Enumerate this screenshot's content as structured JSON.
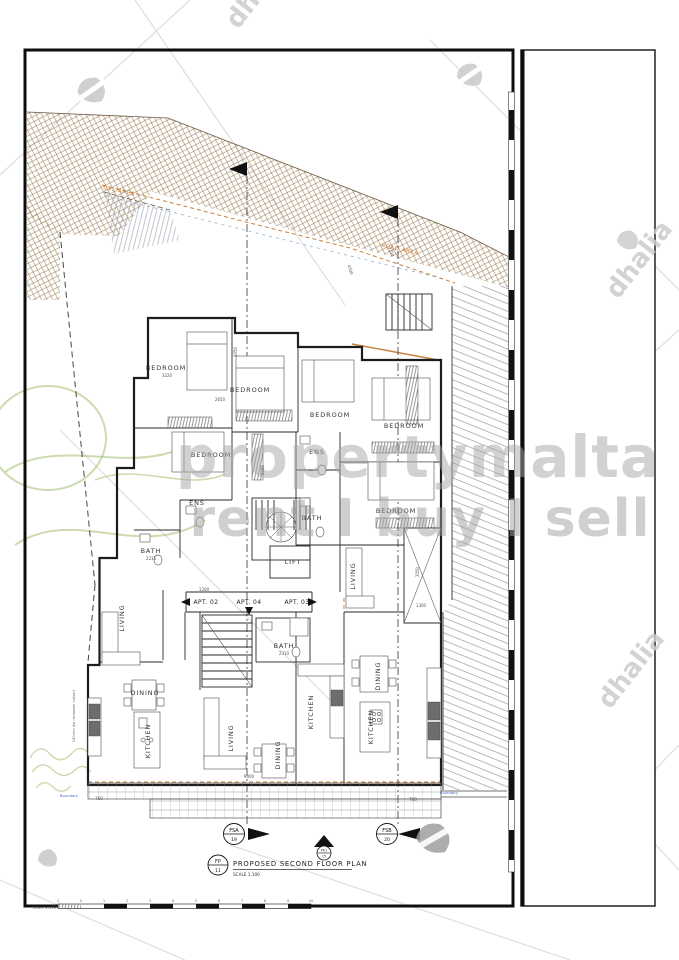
{
  "watermarks": {
    "brand": "propertymalta",
    "tagline": "rent I buy I sell",
    "agency1": "dhalia",
    "agency2": "dhalia",
    "agency3": "dhalia"
  },
  "site": {
    "area_label_left": "DVL AREA",
    "area_label_right": "ROAD AREA",
    "boundary_left": "Boundary",
    "boundary_right": "Boundary",
    "culvert_note": "150mm dia rainwater culvert"
  },
  "plan": {
    "apartments": [
      {
        "label": "APT. 02"
      },
      {
        "label": "APT. 04"
      },
      {
        "label": "APT. 03"
      }
    ],
    "rooms": [
      {
        "label": "BEDROOM"
      },
      {
        "label": "BEDROOM"
      },
      {
        "label": "BEDROOM"
      },
      {
        "label": "BEDROOM"
      },
      {
        "label": "BEDROOM"
      },
      {
        "label": "BEDROOM"
      },
      {
        "label": "ENS"
      },
      {
        "label": "ENS"
      },
      {
        "label": "BATH"
      },
      {
        "label": "BATH"
      },
      {
        "label": "BATH"
      },
      {
        "label": "LIFT"
      },
      {
        "label": "LIVING"
      },
      {
        "label": "LIVING"
      },
      {
        "label": "LIVING"
      },
      {
        "label": "DINING"
      },
      {
        "label": "DINING"
      },
      {
        "label": "DINING"
      },
      {
        "label": "KITCHEN"
      },
      {
        "label": "KITCHEN"
      },
      {
        "label": "KITCHEN"
      }
    ],
    "dimensions": [
      {
        "value": "1200"
      },
      {
        "value": "3220"
      },
      {
        "value": "2215"
      },
      {
        "value": "2310"
      },
      {
        "value": "1300"
      },
      {
        "value": "700"
      },
      {
        "value": "760"
      },
      {
        "value": "9000"
      },
      {
        "value": "3050"
      },
      {
        "value": "2385"
      },
      {
        "value": "3050"
      },
      {
        "value": "4500"
      },
      {
        "value": "3350"
      },
      {
        "value": "2650"
      }
    ]
  },
  "markers": {
    "fsa": {
      "code": "FSA",
      "num": "19"
    },
    "fsb": {
      "code": "FSB",
      "num": "20"
    },
    "pe": {
      "code": "PE1",
      "num": "15"
    }
  },
  "titleblock": {
    "ref_top": "FP",
    "ref_num": "11",
    "title": "PROPOSED SECOND FLOOR PLAN",
    "scale": "SCALE 1:100"
  },
  "scalebar": {
    "label": "Scale 1:100",
    "ticks": [
      "1",
      "0",
      "1",
      "2",
      "3",
      "4",
      "5",
      "6",
      "7",
      "8",
      "9",
      "10"
    ]
  },
  "colors": {
    "boundary_orange": "#c8823c",
    "watermark_gray": "#a6a6a6",
    "hatch_brown": "#a08058"
  }
}
